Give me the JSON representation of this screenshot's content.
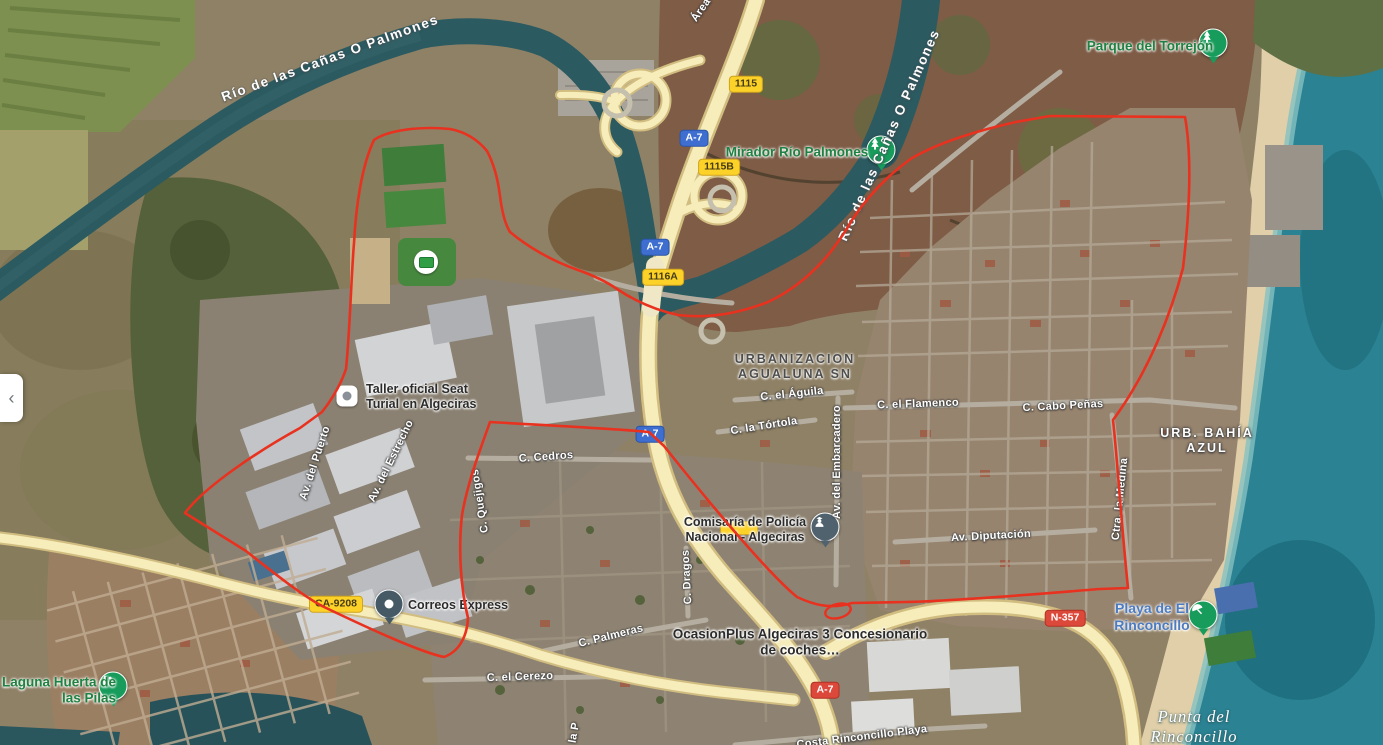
{
  "panel": {
    "collapse_icon": "‹"
  },
  "colors": {
    "boundary_red": "#e9311f",
    "road_yellow": "#f6edbb",
    "sea_teal": "#2a8292",
    "shield_yellow": "#fcd229",
    "shield_blue": "#3e6fd0",
    "shield_red": "#dc4839",
    "poi_green": "#1f8242",
    "beach_label_blue": "#4c7bbf"
  },
  "water_labels": {
    "river_upper": "Río de las Cañas O Palmones",
    "river_right": "Río de las Cañas O Palmones",
    "punta": "Punta del Rinconcillo"
  },
  "area_labels": {
    "urbanizacion": "URBANIZACION AGUALUNA SN",
    "bahia_azul": "URB. BAHÍA AZUL"
  },
  "pois": {
    "parque_torrejon": {
      "label": "Parque del Torrejón",
      "icon": "tree-pin-icon"
    },
    "mirador": {
      "label": "Mirador Río Palmones",
      "icon": "tree-pin-icon"
    },
    "seat": {
      "label": "Taller oficial Seat Turial en Algeciras",
      "icon": "poi-square-icon"
    },
    "correos": {
      "label": "Correos Express",
      "icon": "poi-dot-icon"
    },
    "comisaria": {
      "label": "Comisaría de Policía Nacional - Algeciras",
      "icon": "police-pin-icon"
    },
    "ocasionplus": {
      "label": "OcasionPlus Algeciras 3 Concesionario de coches…"
    },
    "playa": {
      "label": "Playa de El Rinconcillo",
      "icon": "beach-pin-icon"
    },
    "laguna": {
      "label": "Laguna Huerta de las Pilas",
      "icon": "park-pin-icon"
    }
  },
  "street_labels": [
    "C. el Águila",
    "C. el Flamenco",
    "C. Cabo Peñas",
    "C. la Tórtola",
    "Av. del Embarcadero",
    "Av. Diputación",
    "Ctra. la Medina",
    "C. Cedros",
    "C. Quejigos",
    "C. Dragos",
    "C. Palmeras",
    "C. el Cerezo",
    "Av. del Estrecho",
    "Av. del Puerto",
    "Costa Rinconcillo Playa",
    "Área",
    "C. la P"
  ],
  "shields": [
    {
      "label": "1115",
      "type": "yellow"
    },
    {
      "label": "A-7",
      "type": "blue"
    },
    {
      "label": "1115B",
      "type": "yellow"
    },
    {
      "label": "A-7",
      "type": "blue"
    },
    {
      "label": "1116A",
      "type": "yellow"
    },
    {
      "label": "A-7",
      "type": "blue"
    },
    {
      "label": "CA-9208",
      "type": "yellow"
    },
    {
      "label": "A-7",
      "type": "red"
    },
    {
      "label": "N-357",
      "type": "red"
    }
  ]
}
